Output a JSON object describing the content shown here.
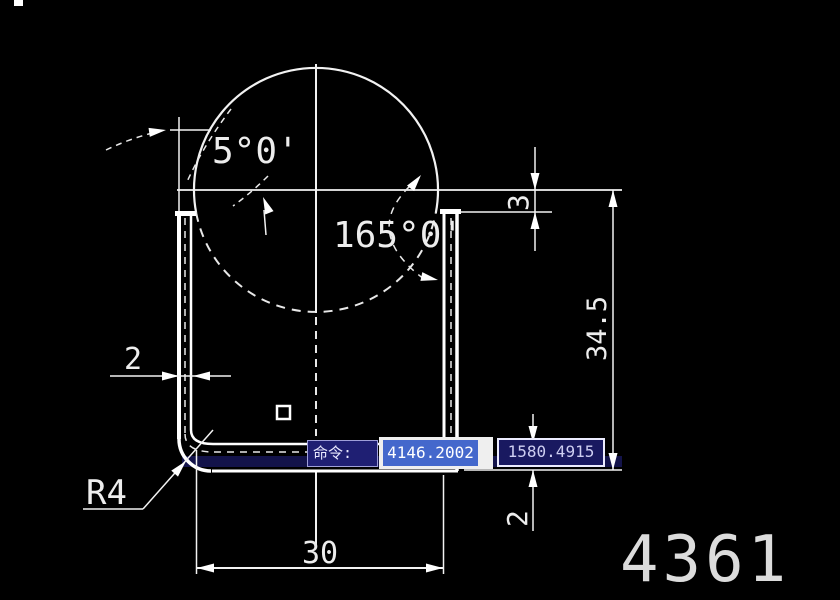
{
  "canvas": {
    "width": 840,
    "height": 600,
    "background": "#000000",
    "line_color": "#f2f2f2"
  },
  "dimensions": {
    "angle_small": "5°0'",
    "angle_large": "165°0'",
    "wall_thickness": "2",
    "bottom_width": "30",
    "fillet_radius": "R4",
    "flange_offset": "3",
    "overall_height": "34.5",
    "bottom_thickness": "2"
  },
  "command_bar": {
    "prompt": "命令:",
    "coord_x": "4146.2002",
    "coord_y": "1580.4915",
    "colors": {
      "prompt_bg": "#1f1f73",
      "highlight_bg": "#4468cc",
      "coord_bg": "#191960",
      "field_bg": "#efefef",
      "coord_text": "#cfcff2"
    }
  },
  "sheet": {
    "number": "4361"
  }
}
